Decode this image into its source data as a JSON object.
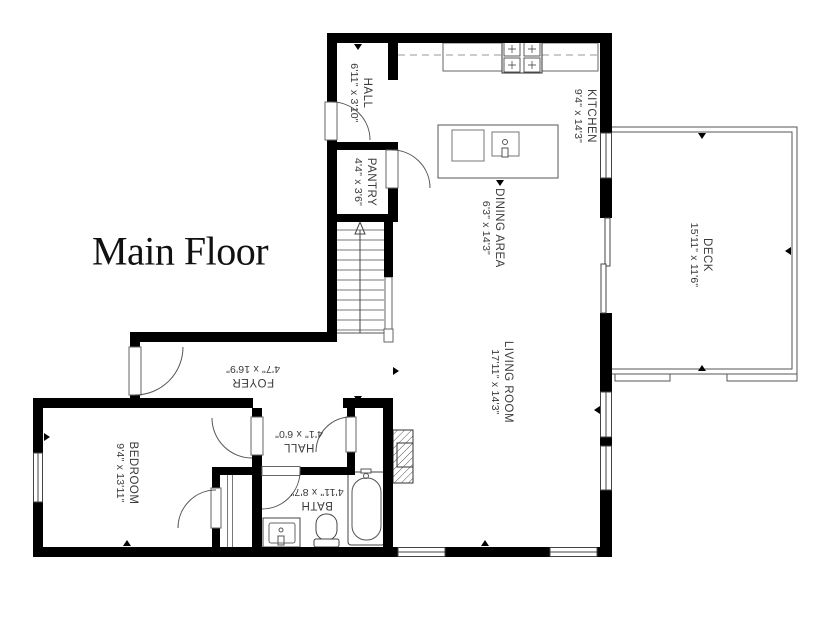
{
  "title": "Main Floor",
  "rooms": [
    {
      "name": "HALL",
      "dims": "6'11\" x 3'10\""
    },
    {
      "name": "PANTRY",
      "dims": "4'4\" x 3'6\""
    },
    {
      "name": "KITCHEN",
      "dims": "9'4\" x 14'3\""
    },
    {
      "name": "DINING AREA",
      "dims": "6'3\" x 14'3\""
    },
    {
      "name": "LIVING ROOM",
      "dims": "17'11\" x 14'3\""
    },
    {
      "name": "DECK",
      "dims": "15'11\" x 11'6\""
    },
    {
      "name": "FOYER",
      "dims": "4'7\" x 16'9\""
    },
    {
      "name": "BEDROOM",
      "dims": "9'4\" x 13'11\""
    },
    {
      "name": "HALL",
      "dims": "4'1\" x 6'0\""
    },
    {
      "name": "BATH",
      "dims": "4'11\" x 8'7\""
    }
  ],
  "colors": {
    "wall": "#000000",
    "line": "#555555",
    "text": "#3a3a3a",
    "background": "#ffffff"
  }
}
